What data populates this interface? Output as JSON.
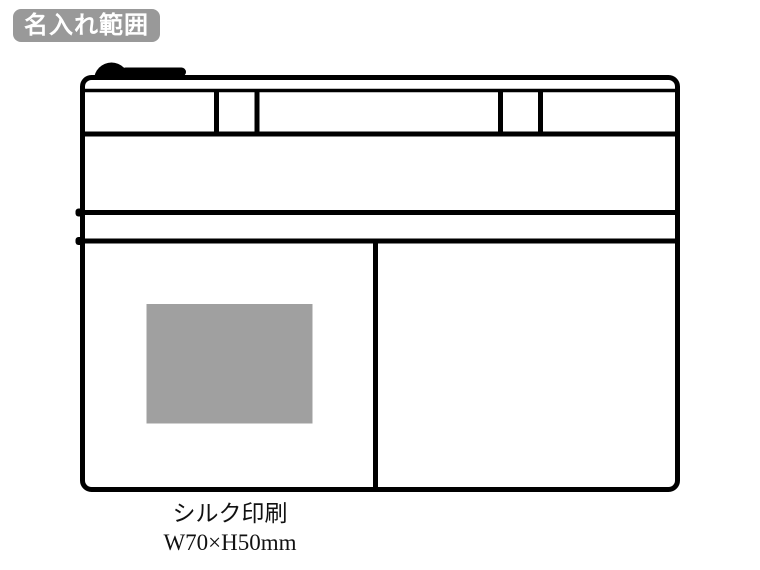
{
  "badge": {
    "label": "名入れ範囲"
  },
  "caption": {
    "print_method": "シルク印刷",
    "print_size": "W70×H50mm"
  },
  "colors": {
    "line": "#000000",
    "badge_background": "#999999",
    "badge_text": "#ffffff",
    "print_area_fill": "#a0a0a0",
    "canvas_background": "#ffffff"
  }
}
